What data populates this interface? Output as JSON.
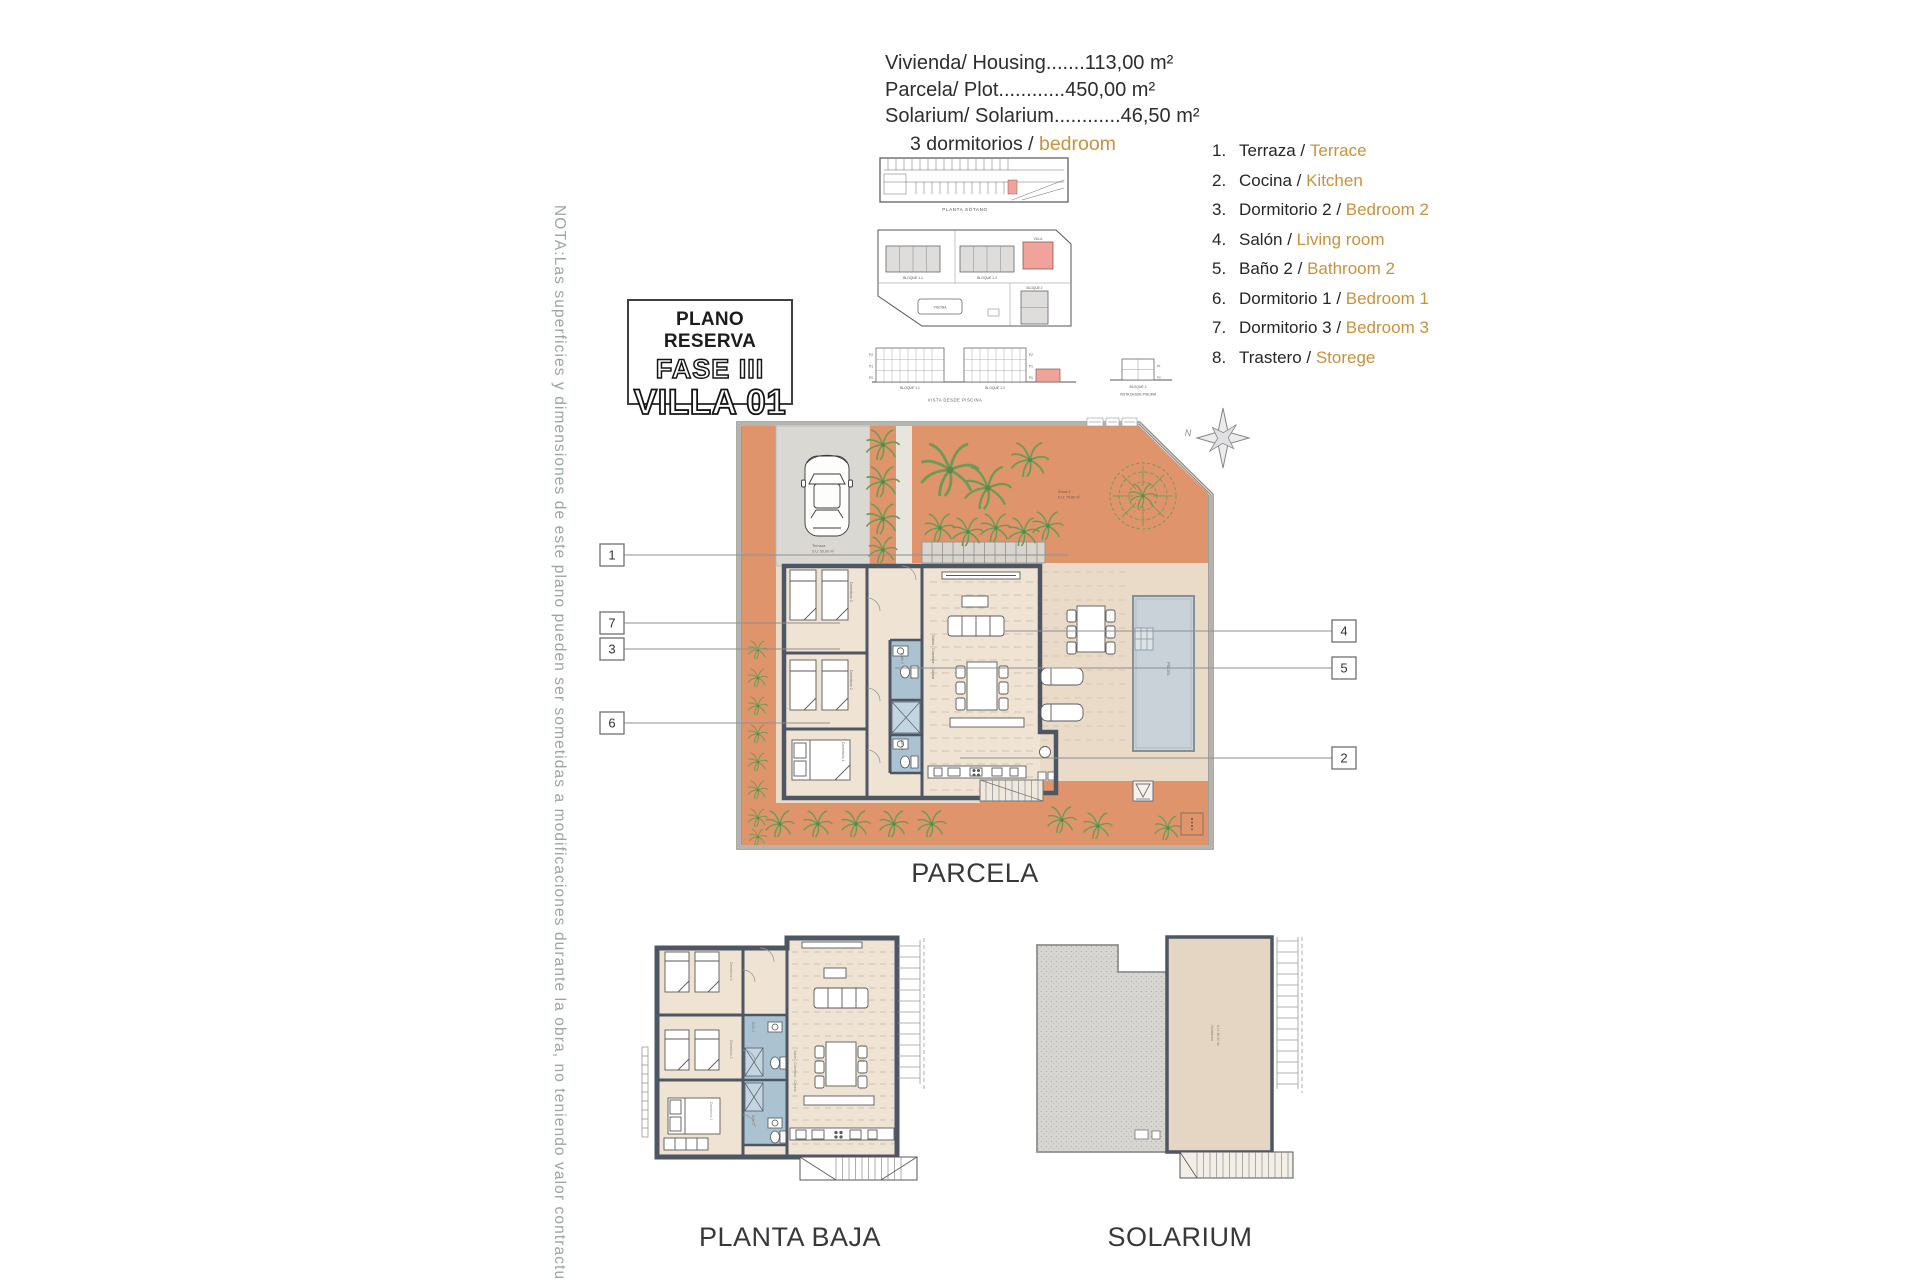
{
  "colors": {
    "accent_orange_text": "#c9913d",
    "terrace_orange": "#e0946c",
    "plot_beige": "#eadbc8",
    "house_floor": "#efe3d4",
    "bathroom_blue": "#abc3d1",
    "wall_dark": "#4e5563",
    "pool_gray": "#c9d2d8",
    "villa_pink": "#efa39a",
    "note_teal_gray": "#98a7a3",
    "plant_green": "#6f9a55"
  },
  "header": {
    "spec_lines": [
      "Vivienda/ Housing.......113,00 m²",
      "Parcela/ Plot............450,00 m²",
      "Solarium/ Solarium............46,50 m²"
    ]
  },
  "subtitle": {
    "prefix": "3 dormitorios / ",
    "highlight": "bedroom"
  },
  "legend": {
    "items": [
      {
        "num": "1.",
        "es": "Terraza",
        "sep": " / ",
        "en": "Terrace"
      },
      {
        "num": "2.",
        "es": "Cocina",
        "sep": " / ",
        "en": "Kitchen"
      },
      {
        "num": "3.",
        "es": "Dormitorio 2",
        "sep": " / ",
        "en": "Bedroom 2"
      },
      {
        "num": "4.",
        "es": "Salón",
        "sep": " / ",
        "en": "Living room"
      },
      {
        "num": "5.",
        "es": "Baño 2",
        "sep": " / ",
        "en": "Bathroom 2"
      },
      {
        "num": "6.",
        "es": "Dormitorio 1",
        "sep": " / ",
        "en": "Bedroom 1"
      },
      {
        "num": "7.",
        "es": "Dormitorio 3",
        "sep": " / ",
        "en": "Bedroom 3"
      },
      {
        "num": "8.",
        "es": "Trastero",
        "sep": " / ",
        "en": "Storege"
      }
    ]
  },
  "title_box": {
    "line1": "PLANO RESERVA",
    "line2": "FASE III",
    "line3": "VILLA 01"
  },
  "note": {
    "text": "NOTA:Las superficies y dimensiones de este plano pueden ser sometidas a modificaciones durante la obra, no teniendo valor contractual."
  },
  "diagrams": {
    "planta_sotano": "PLANTA SÓTANO",
    "bloque11": "BLOQUE 1.1",
    "bloque12": "BLOQUE 1.2",
    "villa": "VILLA",
    "bloque2": "BLOQUE 2",
    "piscina": "PISCINA",
    "vista": "VISTA DESDE PISCINA",
    "floors": [
      "P2",
      "P1",
      "P0"
    ],
    "north": "N"
  },
  "parcela": {
    "label": "PARCELA",
    "callouts_left": [
      "1",
      "7",
      "3",
      "6"
    ],
    "callouts_right": [
      "4",
      "5",
      "2"
    ],
    "rooms": {
      "terraza": "Terraza",
      "terraza_area": "S.U: 55,00 m²",
      "zona2": "Zona 2",
      "zona2_area": "S.U: 70,00 m²",
      "living": "Salón - Comedor - Cocina",
      "bed1": "Dormitorio 1",
      "bed2": "Dormitorio 2",
      "bed3": "Dormitorio 3",
      "bano1": "Baño 1",
      "bano2": "Baño 2",
      "pool": "Piscina"
    }
  },
  "planta_baja": {
    "label": "PLANTA BAJA"
  },
  "solarium": {
    "label": "SOLARIUM",
    "room": "Solarium",
    "area": "S.U: 46,50 m²"
  }
}
